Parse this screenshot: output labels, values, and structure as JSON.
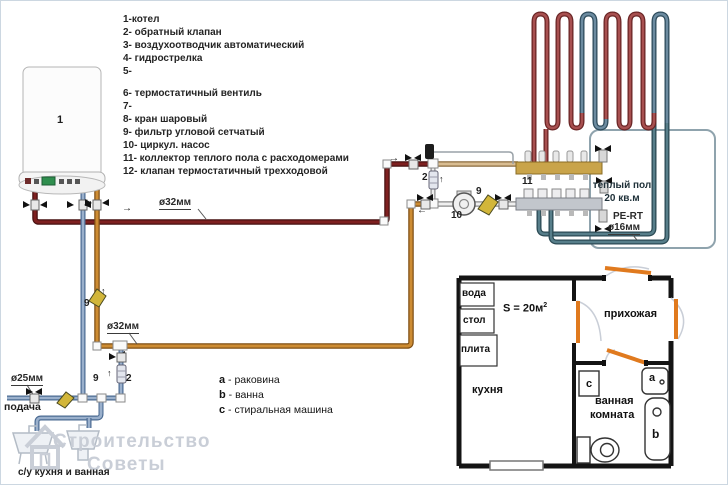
{
  "legend": {
    "items": [
      "1-котел",
      "2- обратный клапан",
      "3- воздухоотводчик автоматический",
      "4- гидрострелка",
      "5-",
      "6- термостатичный вентиль",
      "7-",
      "8- кран шаровый",
      "9- фильтр угловой сетчатый",
      "10- циркул. насос",
      "11- коллектор теплого пола с расходомерами",
      "12- клапан термостатичный трехходовой"
    ]
  },
  "labels": {
    "boiler_num": "1",
    "check_valve_num": "2",
    "filter_num": "9",
    "pump_num": "10",
    "collector_num": "11",
    "d32": "ø32мм",
    "d25": "ø25мм",
    "d16": "ø16мм",
    "pe_rt": "PE-RT",
    "floor_line1": "теплый пол",
    "floor_line2": "20 кв.м",
    "supply": "подача",
    "sanitary": "с/у кухня и ванная"
  },
  "arrows": {
    "right": "→",
    "left": "←",
    "up": "↑"
  },
  "fixtures_legend": [
    {
      "key": "a",
      "desc": " - раковина"
    },
    {
      "key": "b",
      "desc": " - ванна"
    },
    {
      "key": "c",
      "desc": " - стиральная машина"
    }
  ],
  "floor_plan": {
    "area": "S = 20м",
    "area_sup": "2",
    "kitchen": "кухня",
    "hallway": "прихожая",
    "bathroom_line1": "ванная",
    "bathroom_line2": "комната",
    "counters": [
      "вода",
      "стол",
      "плита"
    ],
    "washer": "c",
    "sink": "a",
    "bath": "b"
  },
  "watermark": {
    "line1": "Строительство",
    "line2": "Советы"
  },
  "colors": {
    "supply_pipe": "#7e2020",
    "return_pipe": "#cd8c33",
    "cold_water": "#9ab0cc",
    "floor_supply": "#a64f4f",
    "floor_return": "#5d8694",
    "collector_brass": "#c9a44a",
    "door": "#e07a1e",
    "filter_brass": "#d2b63a"
  }
}
